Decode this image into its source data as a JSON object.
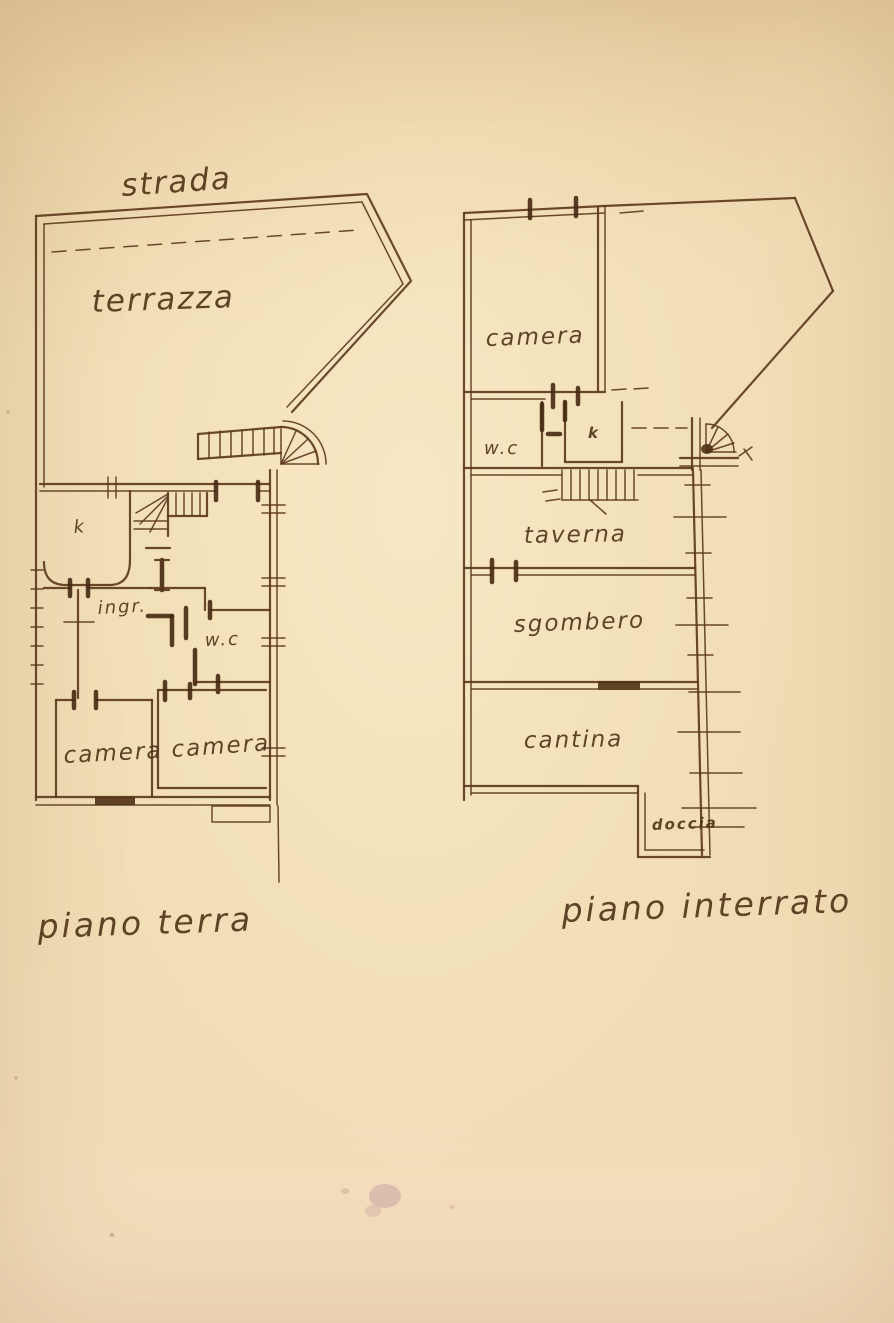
{
  "document": {
    "kind": "hand-drawn floor plan sketch on aged paper",
    "palette": {
      "paper": "#f0dcb4",
      "ink": "#5d3b1d",
      "ink_dark": "#46290f",
      "stain": "#9e678f"
    }
  },
  "ground_floor": {
    "street_label": "strada",
    "terrace_label": "terrazza",
    "kitchen_label": "k",
    "entrance_label": "ingr.",
    "wc_label": "w.c",
    "bedroom_left_label": "camera",
    "bedroom_right_label": "camera",
    "caption": "piano terra"
  },
  "basement": {
    "bedroom_label": "camera",
    "wc_label": "w.c",
    "kitchen_label": "k",
    "tavern_label": "taverna",
    "storage_label": "sgombero",
    "cellar_label": "cantina",
    "shower_label": "doccia",
    "caption": "piano interrato"
  }
}
